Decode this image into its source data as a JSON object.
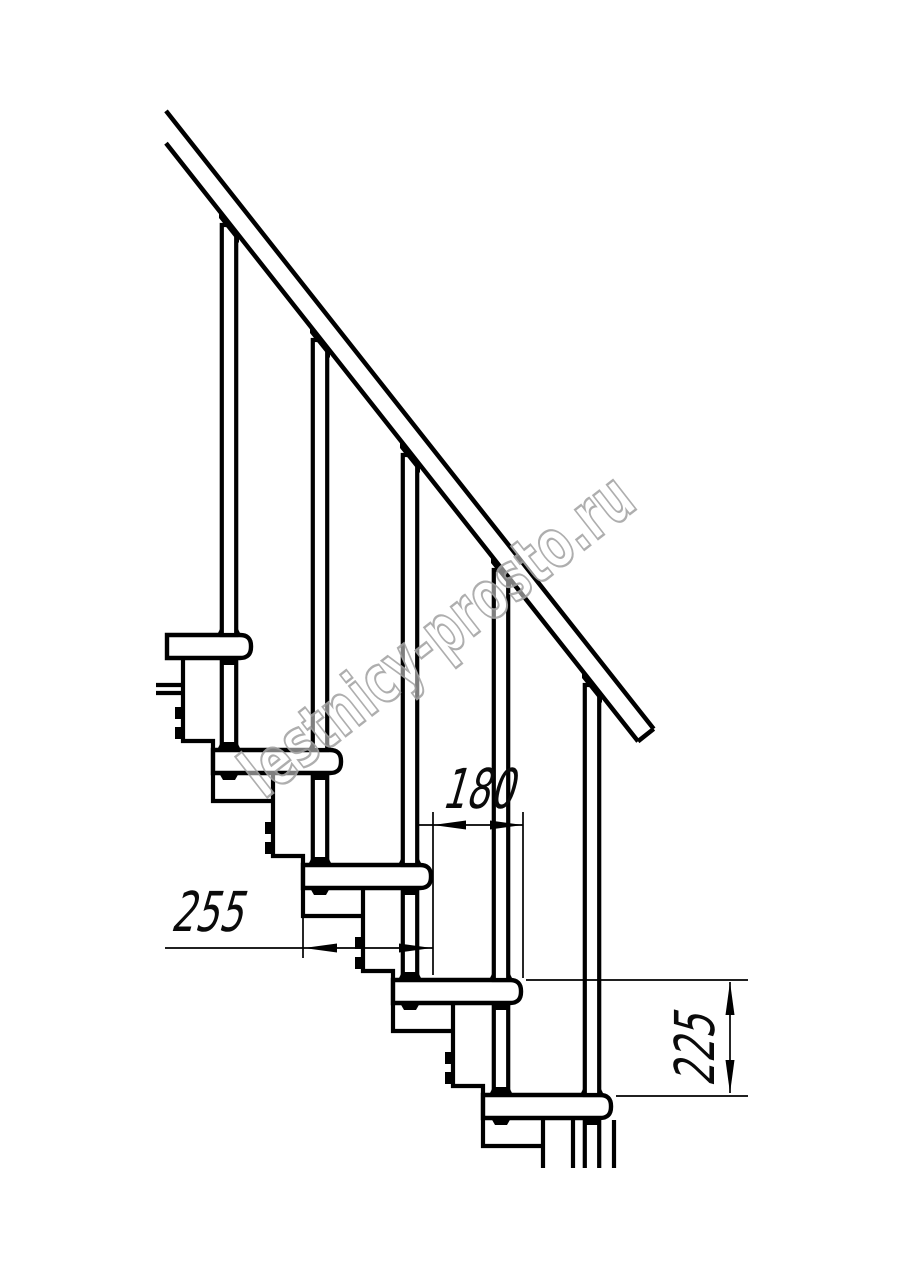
{
  "watermark": {
    "text": "lestnicy-prosto.ru"
  },
  "dimensions": {
    "step_run": {
      "value": "180"
    },
    "tread_depth": {
      "value": "255"
    },
    "step_rise": {
      "value": "225"
    }
  },
  "colors": {
    "ink": "#000000",
    "watermark_gray": "#a6a6a6",
    "background": "#ffffff"
  }
}
